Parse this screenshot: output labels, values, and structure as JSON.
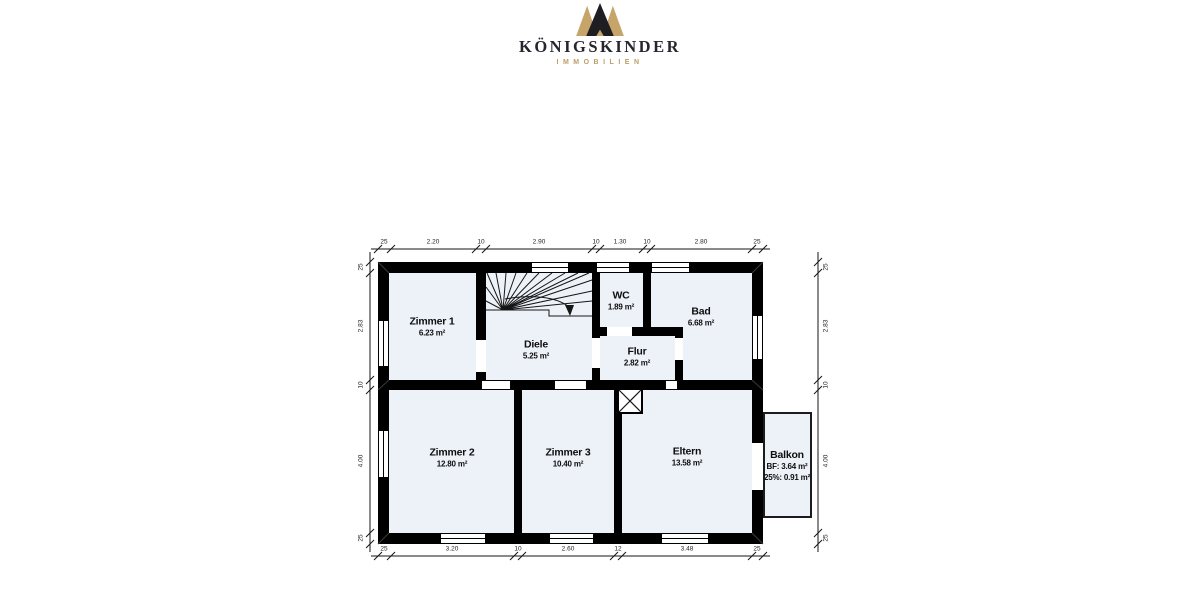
{
  "brand": {
    "name": "KÖNIGSKINDER",
    "tagline": "IMMOBILIEN",
    "colors": {
      "gold": "#C7A469",
      "ink": "#26262E"
    }
  },
  "floorplan": {
    "rooms": [
      {
        "id": "zimmer1",
        "name": "Zimmer 1",
        "area": "6.23 m²"
      },
      {
        "id": "diele",
        "name": "Diele",
        "area": "5.25 m²"
      },
      {
        "id": "wc",
        "name": "WC",
        "area": "1.89 m²"
      },
      {
        "id": "bad",
        "name": "Bad",
        "area": "6.68 m²"
      },
      {
        "id": "flur",
        "name": "Flur",
        "area": "2.82 m²"
      },
      {
        "id": "zimmer2",
        "name": "Zimmer 2",
        "area": "12.80 m²"
      },
      {
        "id": "zimmer3",
        "name": "Zimmer 3",
        "area": "10.40 m²"
      },
      {
        "id": "eltern",
        "name": "Eltern",
        "area": "13.58 m²"
      },
      {
        "id": "balkon",
        "name": "Balkon",
        "area": "BF: 3.64 m²",
        "area2": "25%: 0.91 m²"
      }
    ],
    "dimensions": {
      "top": [
        "25",
        "2.20",
        "10",
        "2.90",
        "10",
        "1.30",
        "10",
        "2.80",
        "25"
      ],
      "bottom": [
        "25",
        "3.20",
        "10",
        "2.60",
        "12",
        "3.48",
        "25"
      ],
      "left": [
        "25",
        "2.83",
        "10",
        "4.00",
        "25"
      ],
      "right": [
        "25",
        "2.83",
        "10",
        "4.00",
        "25"
      ]
    },
    "colors": {
      "wall": "#000000",
      "room_fill": "#EDF2F8",
      "dim_text": "#1E1E1E"
    }
  }
}
